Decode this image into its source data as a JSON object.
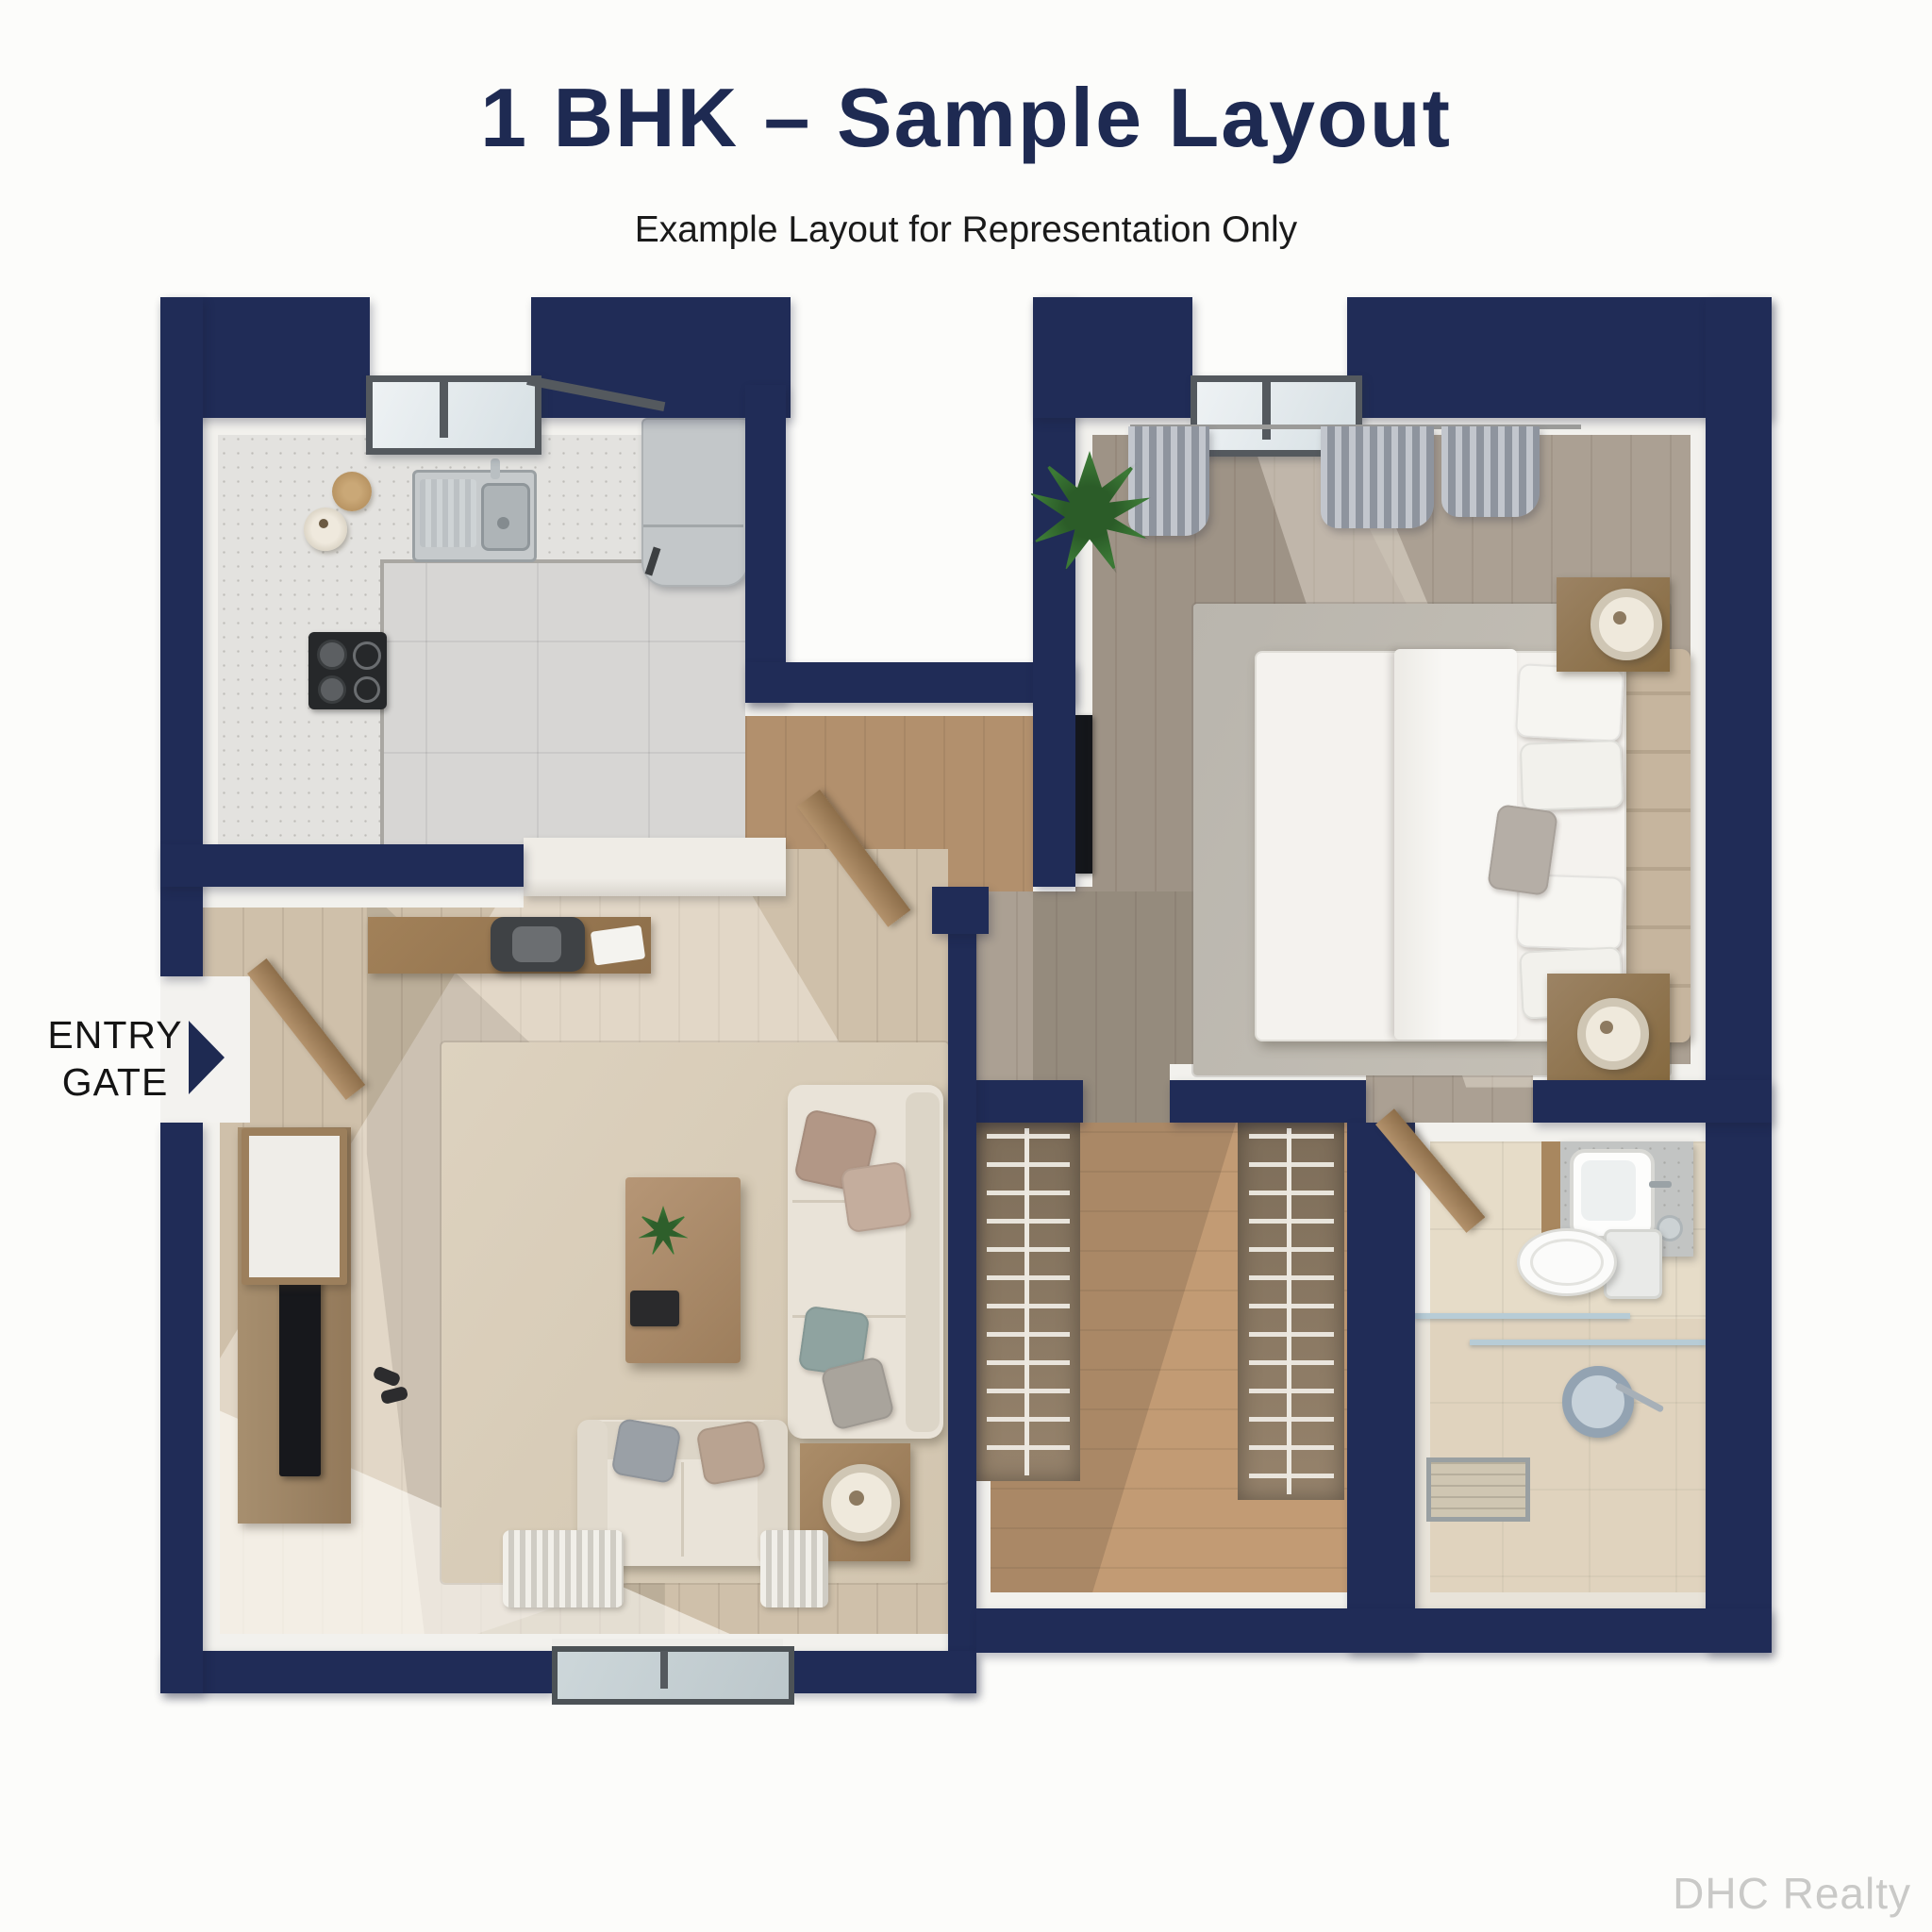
{
  "header": {
    "title": "1 BHK – Sample Layout",
    "subtitle": "Example Layout for Representation Only"
  },
  "plan": {
    "entry_label": "ENTRY GATE"
  },
  "footer": {
    "watermark": "DHC Realty"
  },
  "colors": {
    "wall_navy": "#202c57",
    "title_navy": "#1e2a52",
    "label_black": "#141414",
    "watermark_gray": "#c9c9c7",
    "background": "#fcfcfa",
    "kitchen_tile": "#d7d6d4",
    "living_wood": "#cfc0aa",
    "bedroom_wood": "#aba093",
    "nook_wood": "#b2906d",
    "closet_wood": "#c29b74",
    "bath_tile": "#e6dcc8"
  }
}
